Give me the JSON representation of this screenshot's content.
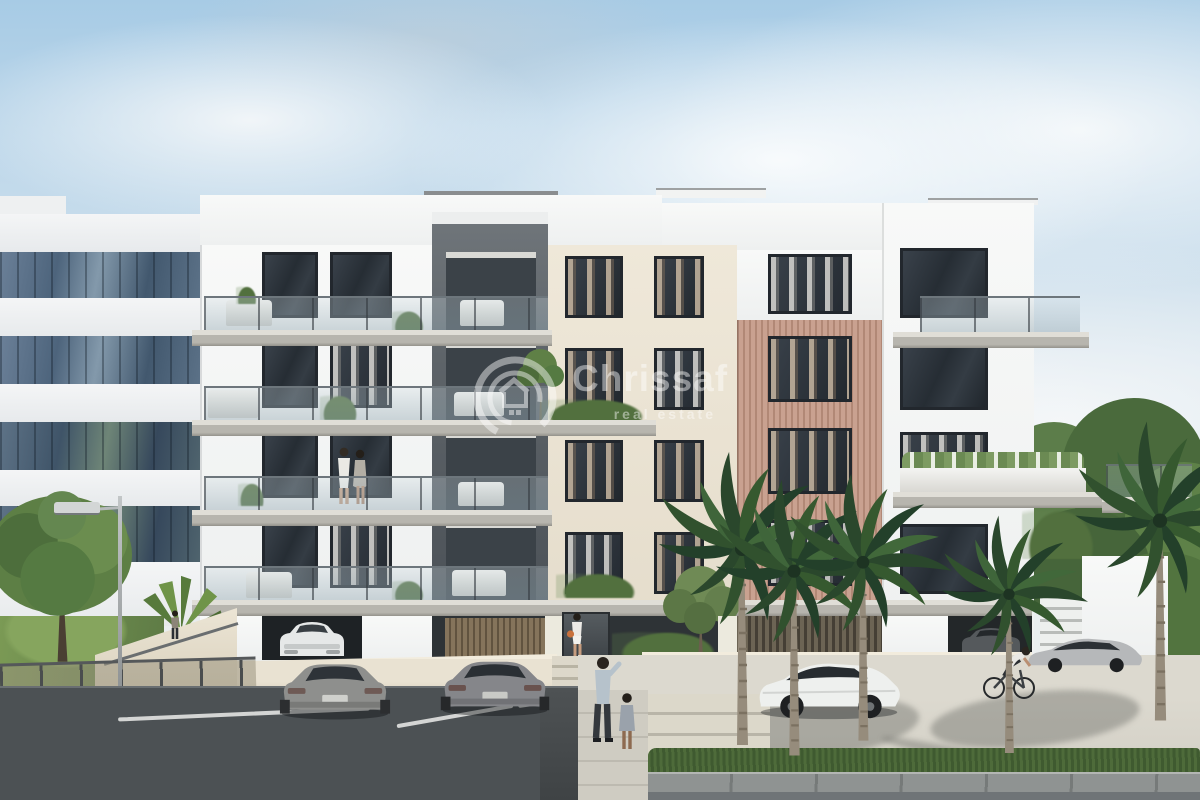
{
  "image": {
    "kind": "real-estate exterior 3D render",
    "watermark": {
      "brand": "Chrissaf",
      "tagline": "real estate",
      "logo": "house-in-double-circle",
      "opacity": 0.45
    }
  },
  "palette": {
    "sky_blue": "#a7cbe5",
    "cloud_white": "#f4f7f9",
    "facade_white": "#f8f9f8",
    "facade_beige": "#e9e2d2",
    "facade_dark_gray": "#5d6368",
    "wood_slats_rose": "#c49d8b",
    "office_glass_blue": "#4d647c",
    "concrete_slab": "#b7b5ae",
    "boundary_wall_cream": "#e9e2d2",
    "asphalt": "#4c5154",
    "road_light": "#d5d2c8",
    "paver_gray": "#8f9392",
    "grass_green": "#7b9a55",
    "palm_green": "#2f4e32",
    "palm_trunk": "#968c7c",
    "car_gray": "#8e8f8d",
    "car_white": "#eef0ee",
    "bag_orange": "#c9713d"
  },
  "scene": {
    "setting": "five-storey apartment building with balconies, parking lot, street and palm trees under a blue cloudy sky",
    "main_building_sections": [
      "white balcony wing",
      "dark grey core",
      "beige window bays",
      "rose wood-slat bay",
      "white corner-balcony wing"
    ],
    "background": [
      "glass office building on the left",
      "green trees on the right"
    ],
    "vehicles": [
      "grey coupe parked",
      "grey coupe parked",
      "white car inside garage",
      "dark car inside garage",
      "white hatchback at kerb",
      "silver car on road"
    ],
    "people": [
      "couple on second-floor balcony",
      "woman at entrance",
      "man walking with child",
      "cyclist",
      "person at ramp"
    ],
    "vegetation": [
      "deciduous tree",
      "small fan palm",
      "tall palm trees",
      "olive trees",
      "hedge",
      "grass verge"
    ],
    "street_furniture": [
      "street lamp",
      "distant street lamp",
      "metal fence",
      "white parking lines",
      "entrance steps"
    ]
  }
}
